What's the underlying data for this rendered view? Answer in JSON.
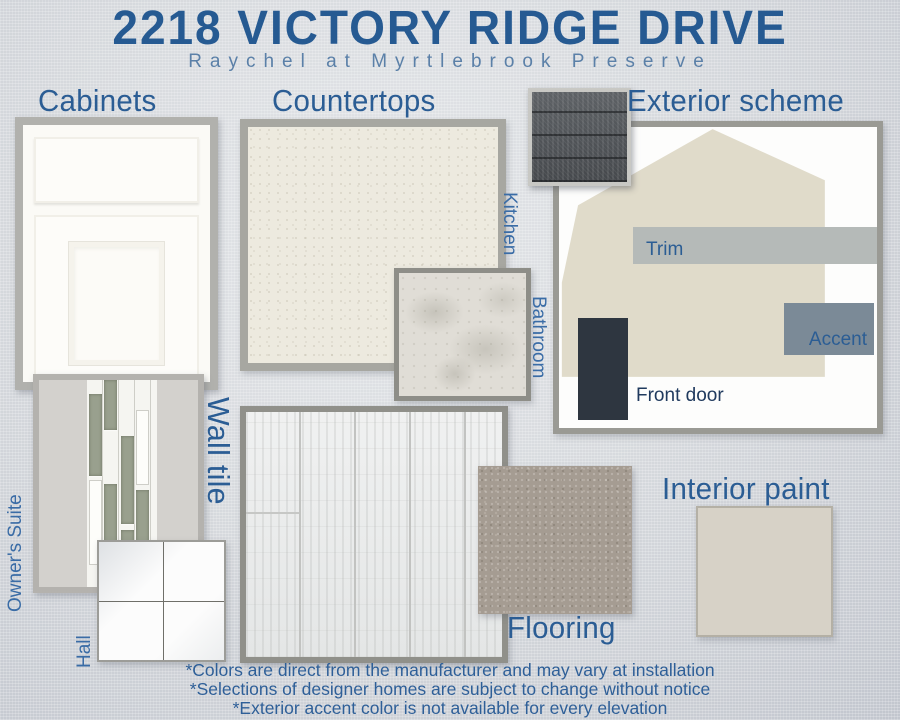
{
  "board": {
    "title": "2218 VICTORY RIDGE DRIVE",
    "subtitle": "Raychel at Myrtlebrook Preserve"
  },
  "sections": {
    "cabinets": {
      "heading": "Cabinets"
    },
    "countertops": {
      "heading": "Countertops",
      "kitchen": "Kitchen",
      "bathroom": "Bathroom"
    },
    "exterior": {
      "heading": "Exterior scheme",
      "trim": "Trim",
      "accent": "Accent",
      "front_door": "Front door"
    },
    "wall_tile": {
      "heading": "Wall tile",
      "owners_suite": "Owner's Suite",
      "hall": "Hall"
    },
    "flooring": {
      "heading": "Flooring"
    },
    "interior_paint": {
      "heading": "Interior paint"
    }
  },
  "disclaimers": [
    "*Colors are direct from the manufacturer and may vary at installation",
    "*Selections of designer homes are subject to change without notice",
    "*Exterior accent color is not available for every elevation"
  ],
  "colors": {
    "title_blue": "#265a92",
    "subtitle_blue": "#5b80a8",
    "heading_blue": "#2b5d94",
    "room_label_blue": "#3a6ca6",
    "disclaimer_blue": "#2e5f98",
    "roof_shingle": "#53575b",
    "house_siding": "#e0dbca",
    "trim": "#b5bab8",
    "accent": "#7b8a97",
    "front_door": "#2e3640",
    "cabinet_white": "#fbfaf6",
    "countertop_kitchen": "#edeadf",
    "countertop_bathroom": "#e0ddd6",
    "wall_tile_field": "#d3d1cd",
    "wall_tile_accent_strip": "#99a08e",
    "hall_tile_white": "#fcfcfc",
    "flooring_plank": "#ebecec",
    "carpet": "#a59c92",
    "interior_paint": "#d7d2c7",
    "background": "#d3d6db"
  }
}
